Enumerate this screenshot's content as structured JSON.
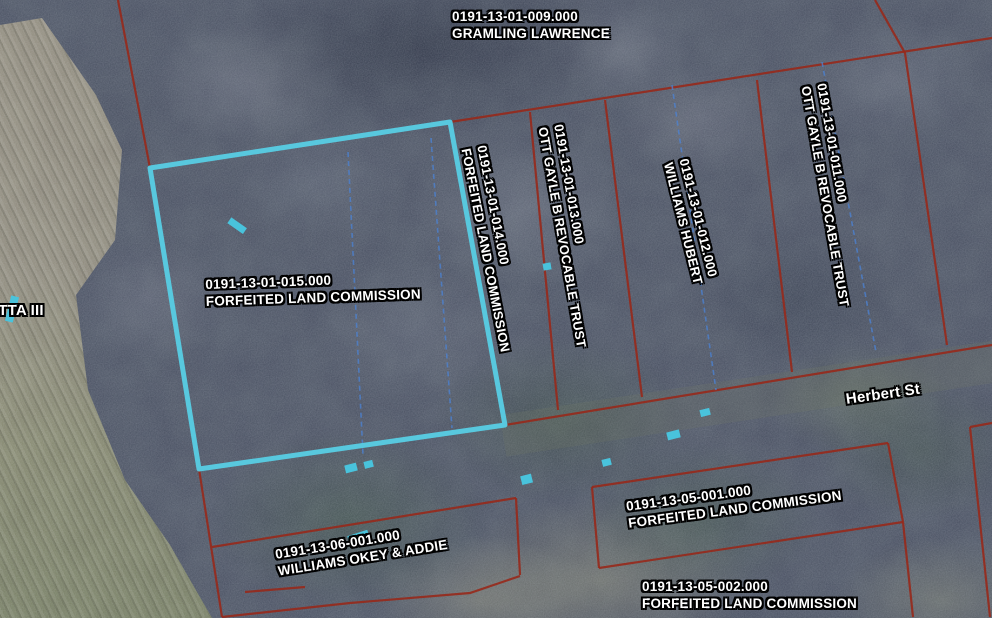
{
  "map": {
    "street_label": "Herbert St",
    "left_edge_label": "ETTA III",
    "selected_parcel_id": "0191-13-01-015.000",
    "parcel_labels": {
      "gramling": {
        "id": "0191-13-01-009.000",
        "owner": "GRAMLING LAWRENCE"
      },
      "flc015": {
        "id": "0191-13-01-015.000",
        "owner": "FORFEITED LAND COMMISSION"
      },
      "flc014": {
        "id": "0191-13-01-014.000",
        "owner": "FORFEITED LAND COMMISSION"
      },
      "ott013": {
        "id": "0191-13-01-013.000",
        "owner": "OTT GAYLE B REVOCABLE TRUST"
      },
      "williams012": {
        "id": "0191-13-01-012.000",
        "owner": "WILLIAMS HUBERT"
      },
      "ott011": {
        "id": "0191-13-01-011.000",
        "owner": "OTT GAYLE B REVOCABLE TRUST"
      },
      "flc05001": {
        "id": "0191-13-05-001.000",
        "owner": "FORFEITED LAND COMMISSION"
      },
      "okey06001": {
        "id": "0191-13-06-001.000",
        "owner": "WILLIAMS OKEY & ADDIE"
      },
      "flc05002": {
        "id": "0191-13-05-002.000",
        "owner": "FORFEITED LAND COMMISSION"
      }
    },
    "colors": {
      "selected_parcel_outline": "#58c8de",
      "parcel_boundary_red": "#97291b",
      "hydro_dashed_blue": "#4b83d6",
      "survey_tick_cyan": "#49c3dc",
      "label_text": "#ffffff",
      "label_halo": "#000000"
    }
  }
}
